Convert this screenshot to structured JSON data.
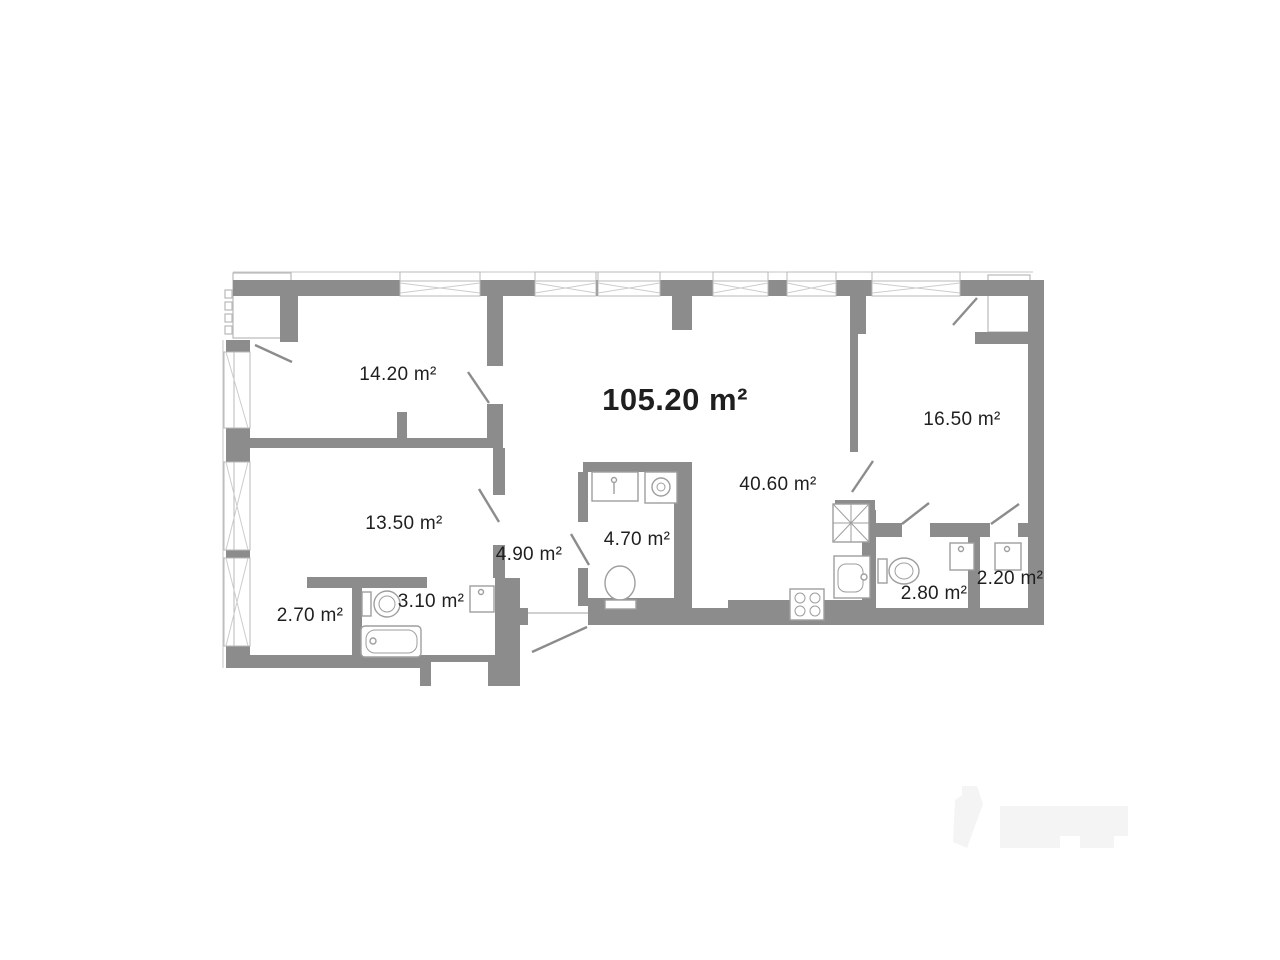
{
  "floor_plan": {
    "total_area_label": "105.20 m²",
    "rooms": [
      {
        "name": "bedroom-top-left",
        "area_label": "14.20 m²"
      },
      {
        "name": "bedroom-top-right",
        "area_label": "16.50 m²"
      },
      {
        "name": "living-kitchen",
        "area_label": "40.60 m²"
      },
      {
        "name": "bedroom-bottom-left",
        "area_label": "13.50 m²"
      },
      {
        "name": "hallway",
        "area_label": "4.90 m²"
      },
      {
        "name": "bathroom-main",
        "area_label": "4.70 m²"
      },
      {
        "name": "wardrobe",
        "area_label": "2.70 m²"
      },
      {
        "name": "bathroom-second",
        "area_label": "3.10 m²"
      },
      {
        "name": "wc",
        "area_label": "2.80 m²"
      },
      {
        "name": "storage",
        "area_label": "2.20 m²"
      }
    ],
    "fixtures": [
      "toilet",
      "bathtub",
      "sink",
      "washing-machine",
      "stove",
      "vent-shaft",
      "window",
      "door-swing",
      "balcony"
    ],
    "colors": {
      "wall": "#8c8c8c",
      "outline": "#bdbdbd",
      "fixture_stroke": "#9e9e9e",
      "text": "#1f1f1f",
      "background": "#ffffff",
      "watermark": "#f4f4f4"
    }
  }
}
